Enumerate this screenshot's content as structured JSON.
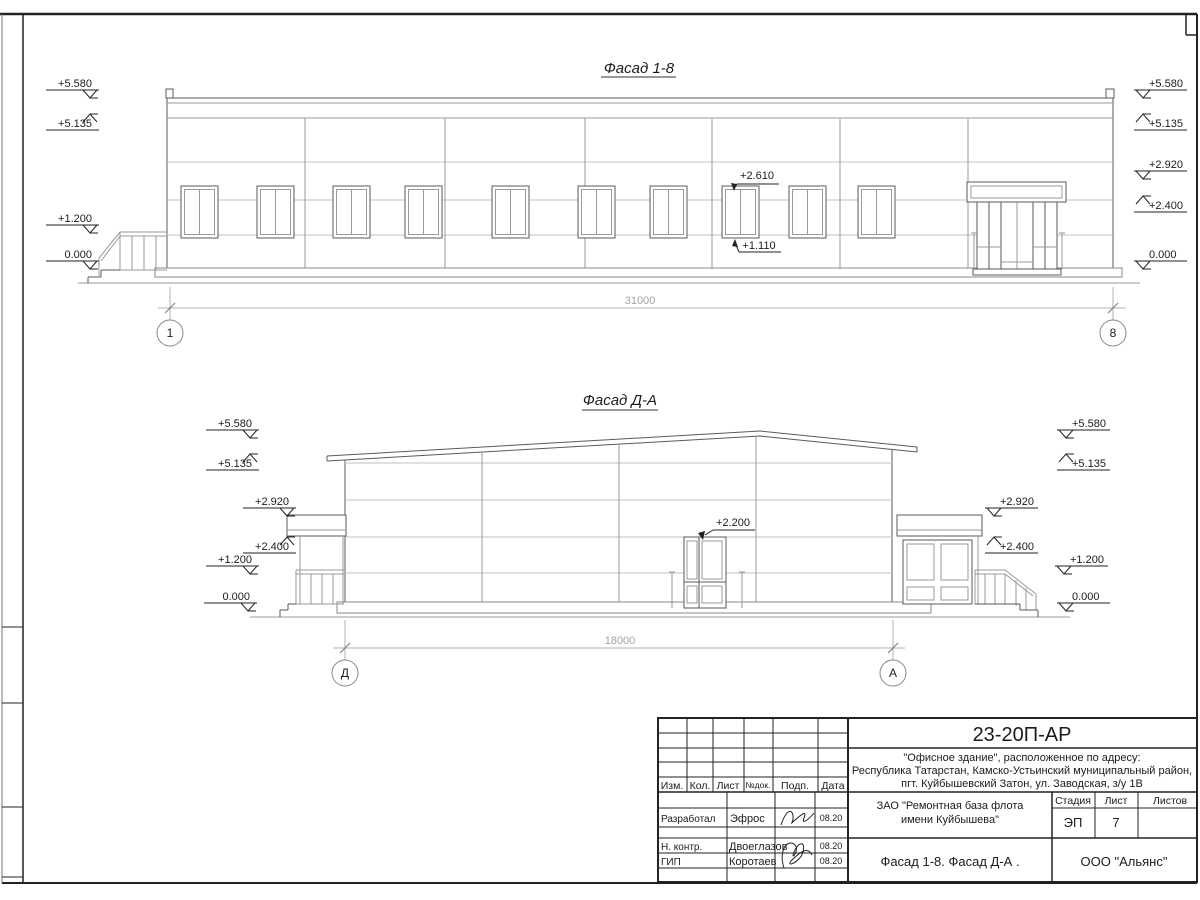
{
  "facade_1_8": {
    "title": "Фасад 1-8",
    "elevation_marks_left": [
      "+5.580",
      "+5.135",
      "+1.200",
      "0.000"
    ],
    "elevation_marks_right": [
      "+5.580",
      "+5.135",
      "+2.920",
      "+2.400",
      "0.000"
    ],
    "window_head_mark": "+2.610",
    "window_sill_mark": "+1.110",
    "overall_dimension": "31000",
    "axis_start": "1",
    "axis_end": "8"
  },
  "facade_d_a": {
    "title": "Фасад Д-А",
    "elevation_marks_left": [
      "+5.580",
      "+5.135",
      "+2.920",
      "+2.400",
      "+1.200",
      "0.000"
    ],
    "elevation_marks_right": [
      "+5.580",
      "+5.135",
      "+2.920",
      "+2.400",
      "+1.200",
      "0.000"
    ],
    "door_head_mark": "+2.200",
    "overall_dimension": "18000",
    "axis_start": "Д",
    "axis_end": "А"
  },
  "title_block": {
    "document_number": "23-20П-АР",
    "project_lines": [
      "\"Офисное здание\", расположенное по адресу:",
      "Республика Татарстан, Камско-Устьинский муниципальный район,",
      "пгт. Куйбышевский Затон, ул. Заводская, з/у 1В"
    ],
    "client_lines": [
      "ЗАО \"Ремонтная база флота",
      "имени Куйбышева\""
    ],
    "sheet_title": "Фасад 1-8. Фасад Д-А .",
    "organization": "ООО \"Альянс\"",
    "stage_label": "Стадия",
    "sheet_label": "Лист",
    "sheets_label": "Листов",
    "stage_value": "ЭП",
    "sheet_value": "7",
    "revision_headers": [
      "Изм.",
      "Кол.",
      "Лист",
      "№док.",
      "Подп.",
      "Дата"
    ],
    "signers": [
      {
        "role": "Разработал",
        "name": "Эфрос",
        "date": "08.20"
      },
      {
        "role": "Н. контр.",
        "name": "Двоеглазов",
        "date": "08.20"
      },
      {
        "role": "ГИП",
        "name": "Коротаев",
        "date": "08.20"
      }
    ]
  }
}
